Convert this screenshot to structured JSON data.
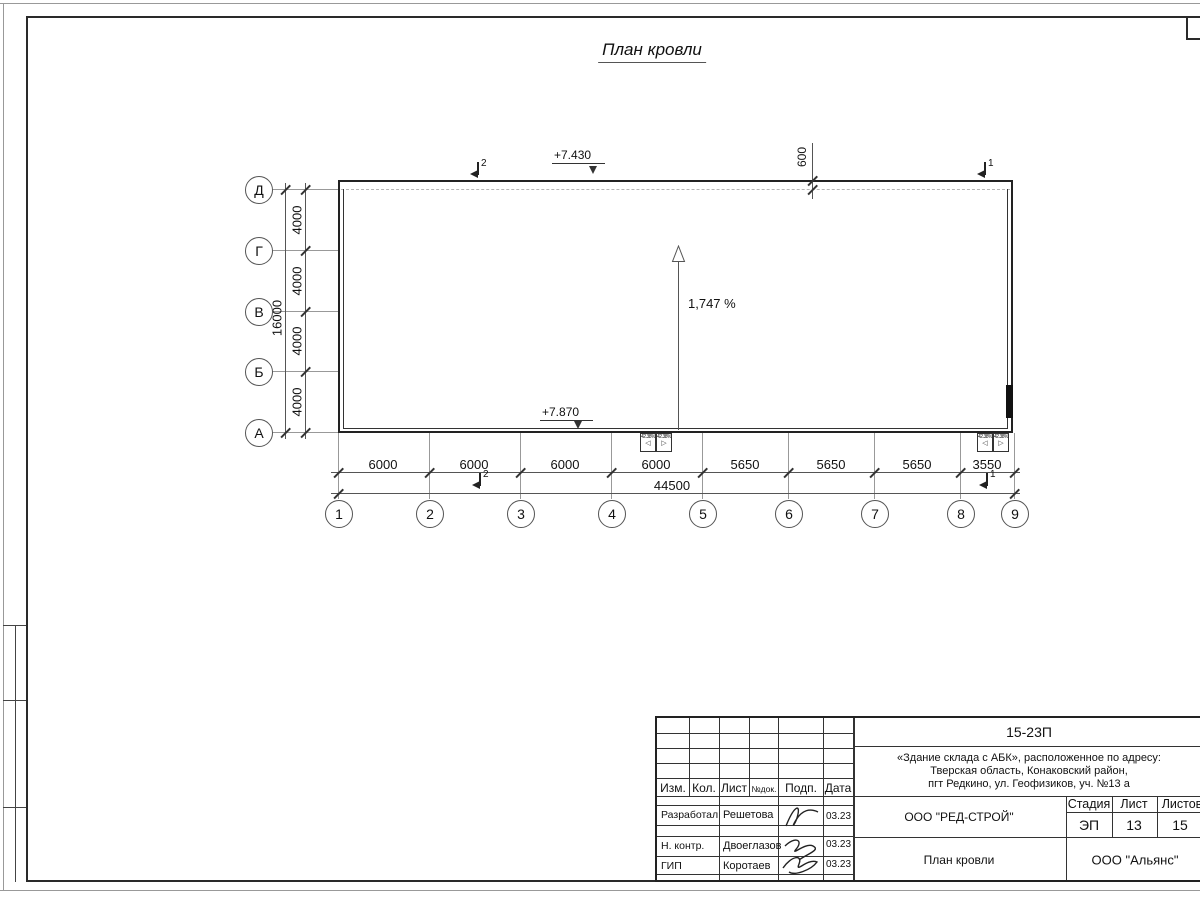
{
  "page": {
    "title": "План кровли"
  },
  "drawing": {
    "elevation_top": "+7.430",
    "elevation_bottom": "+7.870",
    "slope_label": "1,747 %",
    "offset_dim": "600",
    "canopy_slope": "42.38%",
    "section_mark_left": "2",
    "section_mark_right": "1",
    "row_axes": [
      "Д",
      "Г",
      "В",
      "Б",
      "А"
    ],
    "col_axes": [
      "1",
      "2",
      "3",
      "4",
      "5",
      "6",
      "7",
      "8",
      "9"
    ],
    "row_dims": [
      "4000",
      "4000",
      "4000",
      "4000"
    ],
    "row_total": "16000",
    "col_dims": [
      "6000",
      "6000",
      "6000",
      "6000",
      "5650",
      "5650",
      "5650",
      "3550"
    ],
    "col_total": "44500"
  },
  "title_block": {
    "code": "15-23П",
    "address_line1": "«Здание склада с АБК», расположенное по адресу:",
    "address_line2": "Тверская область, Конаковский район,",
    "address_line3": "пгт Редкино, ул. Геофизиков, уч. №13 а",
    "org": "ООО \"РЕД-СТРОЙ\"",
    "contractor": "ООО \"Альянс\"",
    "sheet_title": "План кровли",
    "stage_label": "Стадия",
    "sheet_label": "Лист",
    "sheets_label": "Листов",
    "stage": "ЭП",
    "sheet": "13",
    "sheets": "15",
    "header": {
      "izm": "Изм.",
      "kol": "Кол.",
      "list": "Лист",
      "ndok": "№док.",
      "podp": "Подп.",
      "data": "Дата"
    },
    "rows": [
      {
        "role": "Разработал",
        "name": "Решетова",
        "date": "03.23"
      },
      {
        "role": "Н. контр.",
        "name": "Двоеглазов",
        "date": "03.23"
      },
      {
        "role": "ГИП",
        "name": "Коротаев",
        "date": "03.23"
      }
    ]
  }
}
